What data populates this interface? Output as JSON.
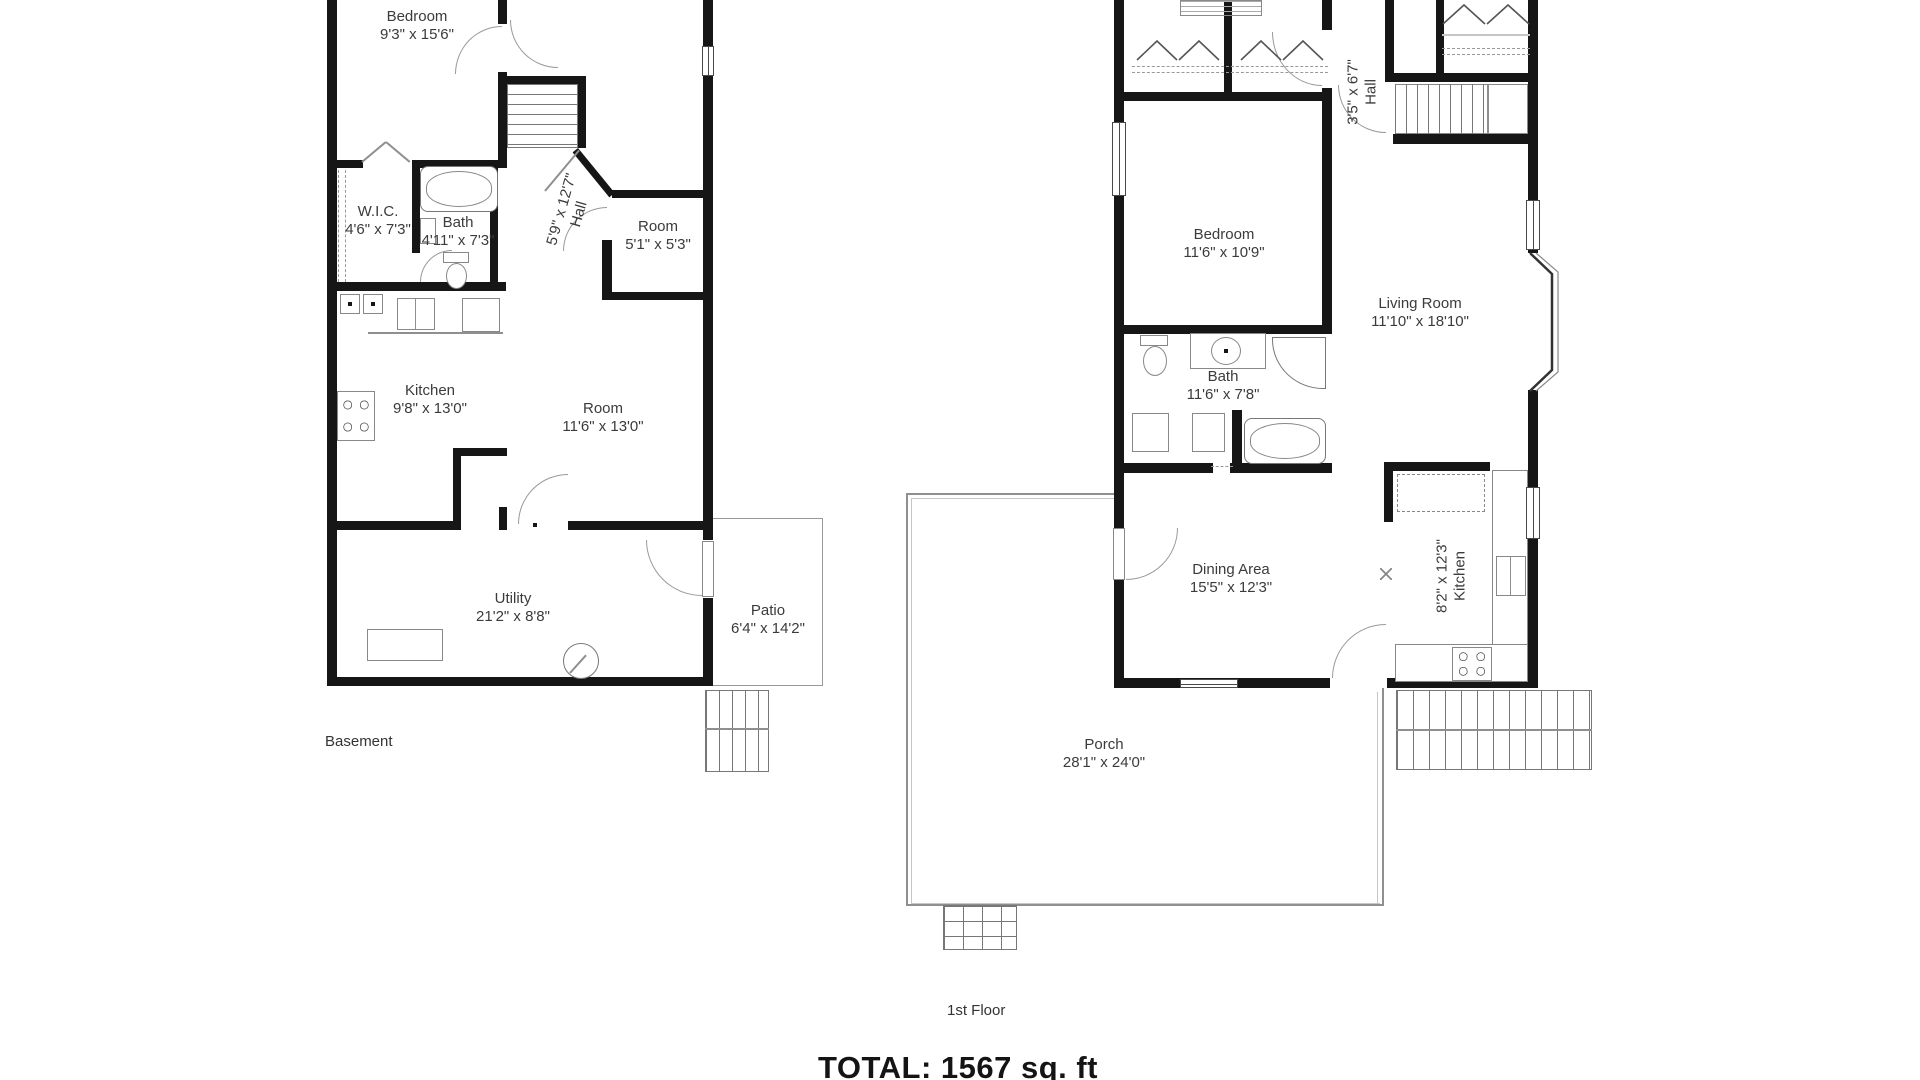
{
  "floors": [
    {
      "name": "Basement",
      "rooms": [
        {
          "name": "Bedroom",
          "dims": "9'3\" x 15'6\""
        },
        {
          "name": "W.I.C.",
          "dims": "4'6\" x 7'3\""
        },
        {
          "name": "Bath",
          "dims": "4'11\" x 7'3\""
        },
        {
          "name": "Hall",
          "dims": "5'9\" x 12'7\""
        },
        {
          "name": "Room",
          "dims": "5'1\" x 5'3\""
        },
        {
          "name": "Kitchen",
          "dims": "9'8\" x 13'0\""
        },
        {
          "name": "Room",
          "dims": "11'6\" x 13'0\""
        },
        {
          "name": "Utility",
          "dims": "21'2\" x 8'8\""
        },
        {
          "name": "Patio",
          "dims": "6'4\" x 14'2\""
        }
      ]
    },
    {
      "name": "1st Floor",
      "rooms": [
        {
          "name": "Hall",
          "dims": "3'5\" x 6'7\""
        },
        {
          "name": "Bedroom",
          "dims": "11'6\" x 10'9\""
        },
        {
          "name": "Living Room",
          "dims": "11'10\" x 18'10\""
        },
        {
          "name": "Bath",
          "dims": "11'6\" x 7'8\""
        },
        {
          "name": "Dining Area",
          "dims": "15'5\" x 12'3\""
        },
        {
          "name": "Kitchen",
          "dims": "8'2\" x 12'3\""
        },
        {
          "name": "Porch",
          "dims": "28'1\" x 24'0\""
        }
      ]
    }
  ],
  "total_label": "TOTAL: 1567 sq. ft",
  "line_color": "#161616",
  "thin_line_color": "#8f8f8f",
  "label_color": "#3b3b3b"
}
